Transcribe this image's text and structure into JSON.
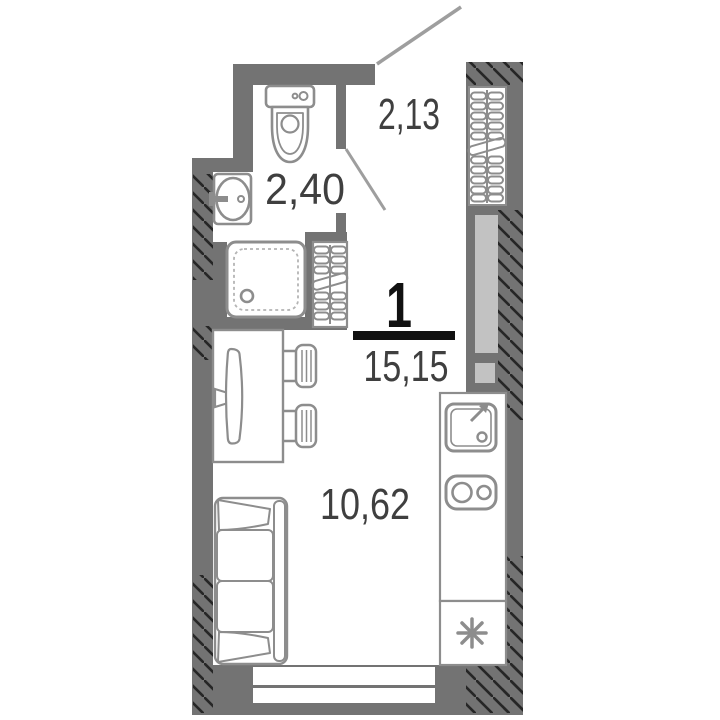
{
  "plan": {
    "unit_number": "1",
    "total_area": "15,15",
    "rooms": [
      {
        "name": "hallway",
        "area": "2,13"
      },
      {
        "name": "bathroom",
        "area": "2,40"
      },
      {
        "name": "living-room",
        "area": "10,62"
      }
    ],
    "fixtures": [
      "toilet",
      "wash-basin",
      "shower-cabin",
      "hanger-rack",
      "wardrobe",
      "dining-table",
      "tv",
      "chair",
      "chair",
      "sofa",
      "kitchen-counter",
      "kitchen-sink",
      "stove-2-burner",
      "refrigerator",
      "window",
      "entrance-opening",
      "door-swing",
      "callout-line"
    ],
    "refrigerator_symbol": "asterisk"
  },
  "colors": {
    "wall": "#737373",
    "panel": "#c2c2c2",
    "outline": "#8d8d8d",
    "hatch": "#262626",
    "line": "#9e9e9e",
    "label": "#3f3f3f",
    "emphasis": "#111111",
    "background": "#ffffff"
  }
}
